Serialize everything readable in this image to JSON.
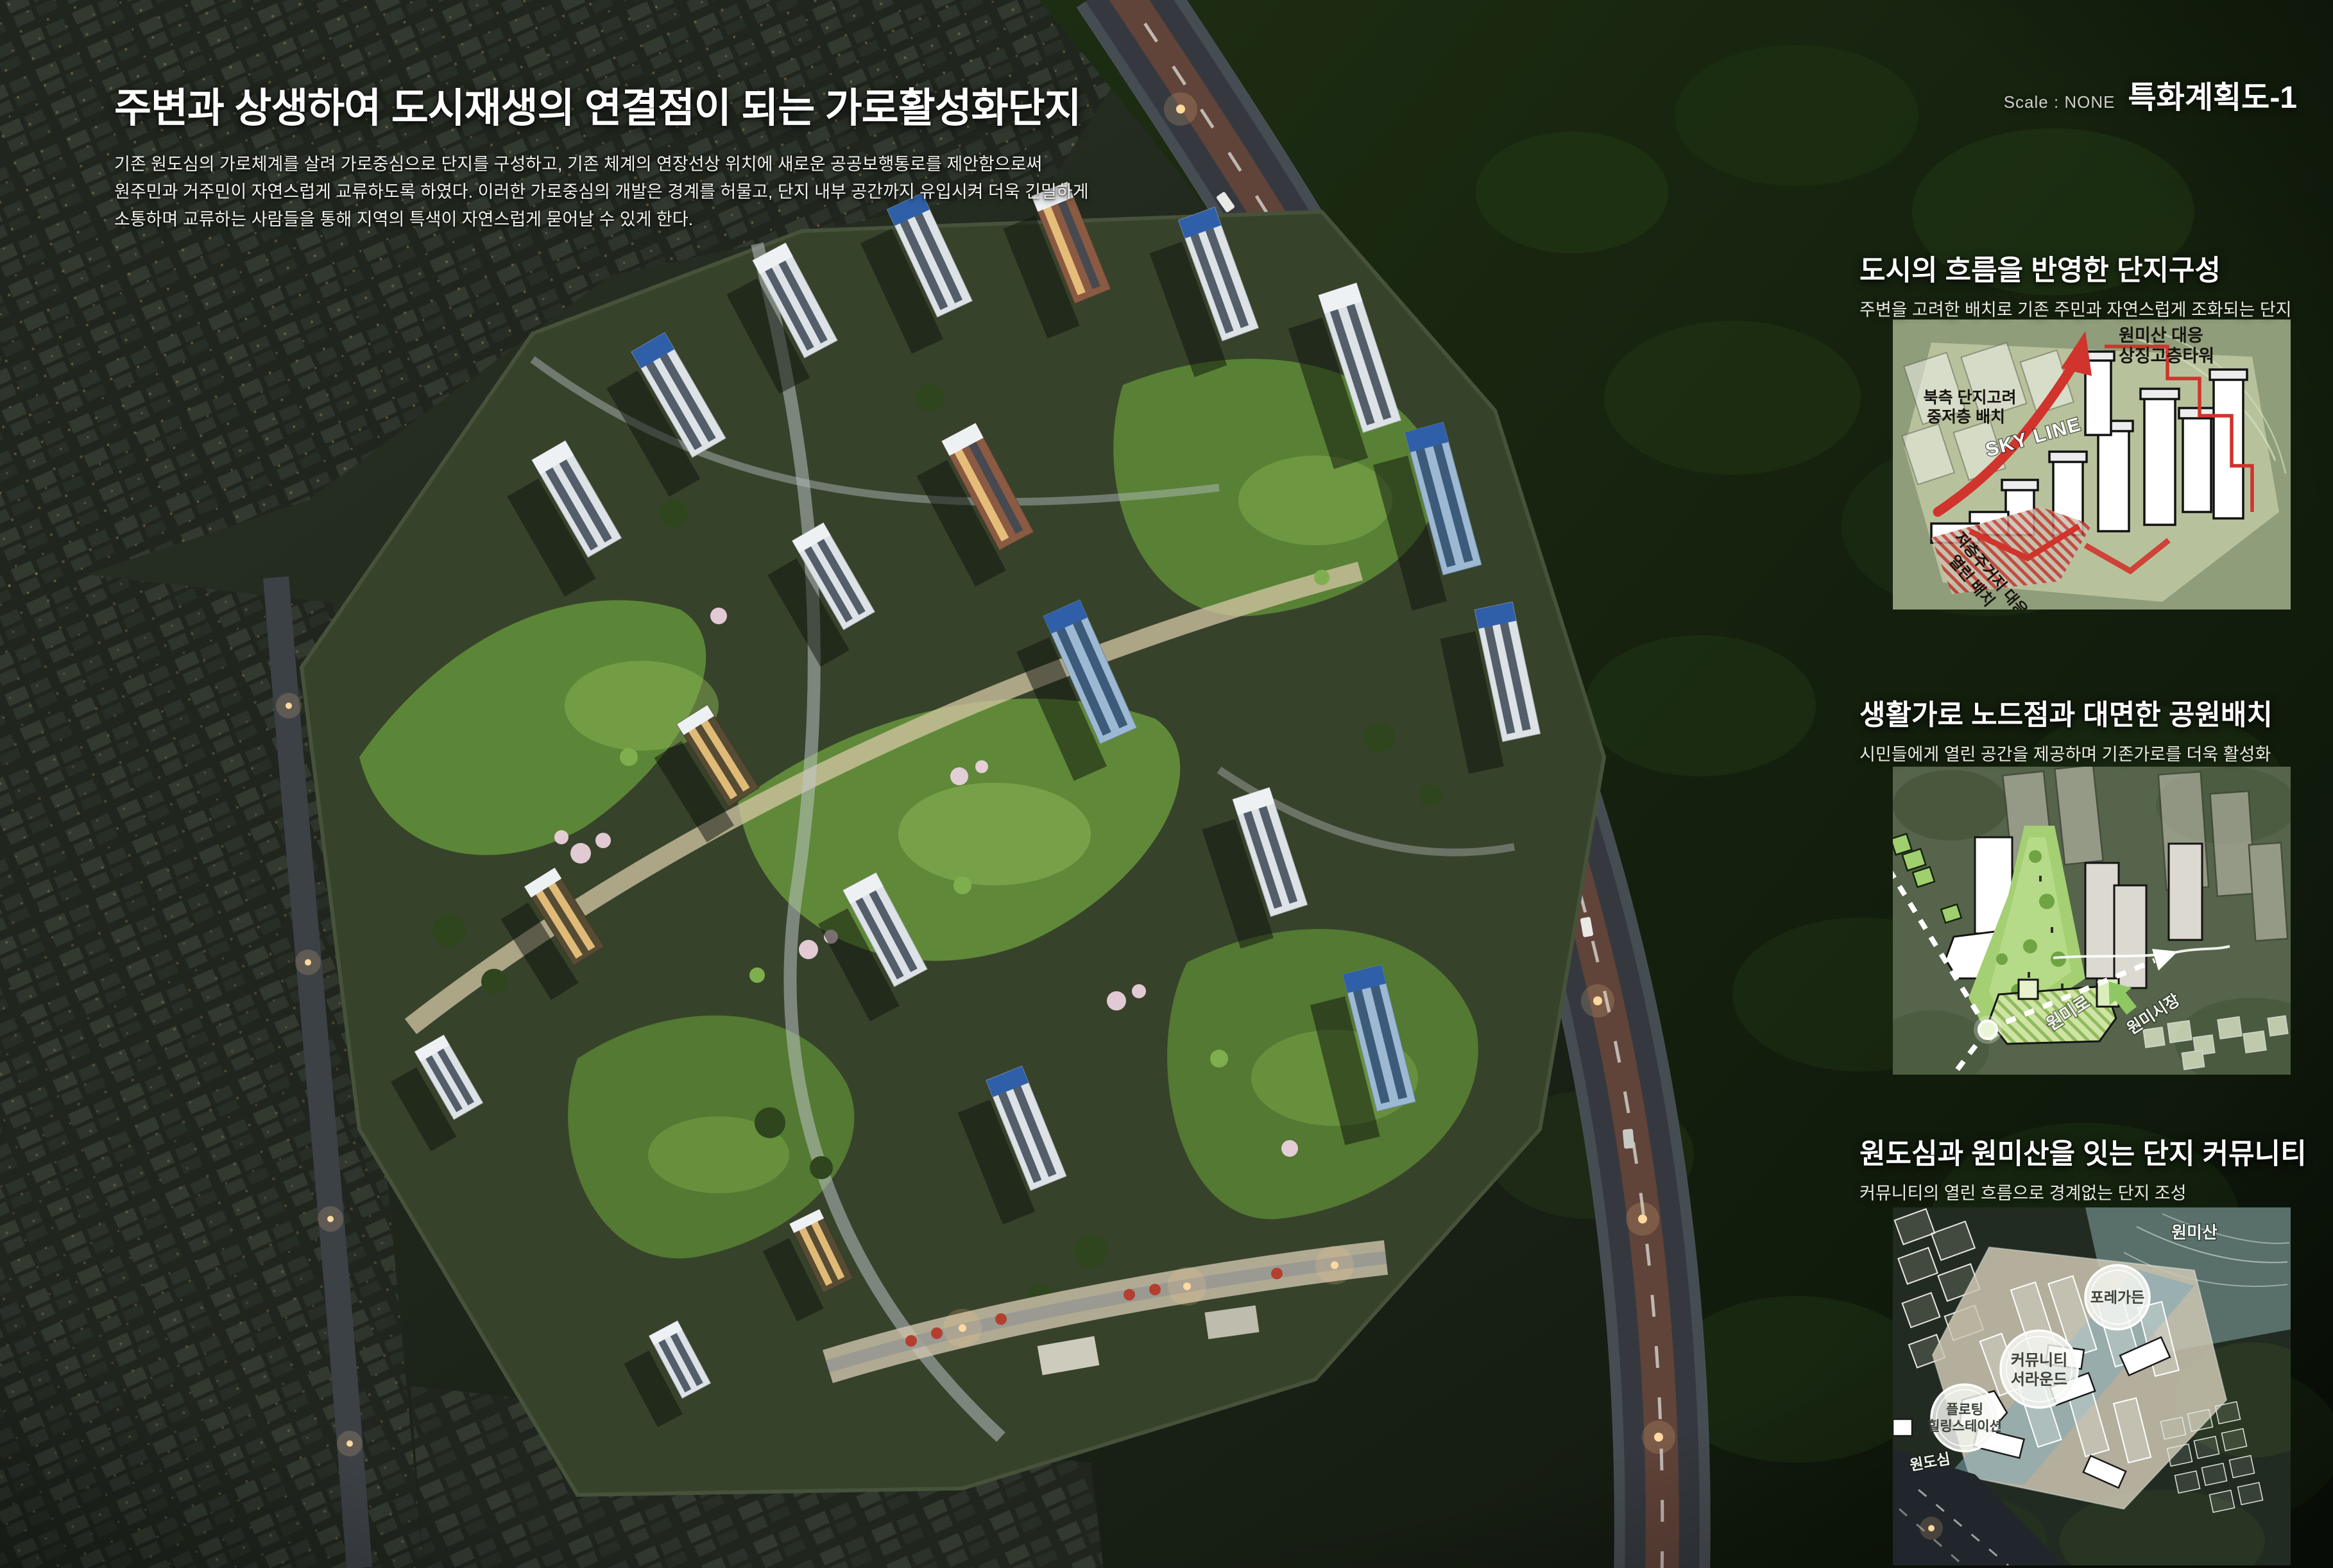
{
  "drawing": {
    "scale_label": "Scale : NONE",
    "code": "특화계획도-1"
  },
  "header": {
    "title": "주변과 상생하여 도시재생의 연결점이 되는 가로활성화단지",
    "paragraph": [
      "기존 원도심의 가로체계를 살려 가로중심으로 단지를 구성하고, 기존 체계의 연장선상 위치에 새로운 공공보행통로를 제안함으로써",
      "원주민과 거주민이 자연스럽게 교류하도록 하였다. 이러한 가로중심의 개발은 경계를 허물고, 단지 내부 공간까지 유입시켜 더욱 긴밀하게",
      "소통하며 교류하는 사람들을 통해 지역의 특색이 자연스럽게 묻어날 수 있게 한다."
    ]
  },
  "sections": [
    {
      "title": "도시의 흐름을 반영한 단지구성",
      "subtitle": "주변을 고려한 배치로 기존 주민과 자연스럽게 조화되는 단지",
      "labels": {
        "tower_line1": "원미산 대응",
        "tower_line2": "상징고층타워",
        "north_line1": "북측 단지고려",
        "north_line2": "중저층 배치",
        "skyline": "SKY LINE",
        "open_line1": "저층주거지 대응",
        "open_line2": "열린 배치"
      }
    },
    {
      "title": "생활가로 노드점과 대면한 공원배치",
      "subtitle": "시민들에게 열린 공간을 제공하며 기존가로를 더욱 활성화",
      "labels": {
        "road": "원미로",
        "market": "원미시장"
      }
    },
    {
      "title": "원도심과 원미산을 잇는 단지 커뮤니티",
      "subtitle": "커뮤니티의 열린 흐름으로 경계없는 단지 조성",
      "labels": {
        "mountain": "원미산",
        "garden": "포레가든",
        "community_line1": "커뮤니티",
        "community_line2": "서라운드",
        "floating_line1": "플로팅",
        "floating_line2": "힐링스테이션",
        "downtown": "원도심"
      }
    }
  ],
  "colors": {
    "accent_red": "#d0342c",
    "park_green": "#a4cf73",
    "flow_blue": "#7fa9b8",
    "night_forest": "#16250f",
    "text_white": "#ffffff"
  }
}
